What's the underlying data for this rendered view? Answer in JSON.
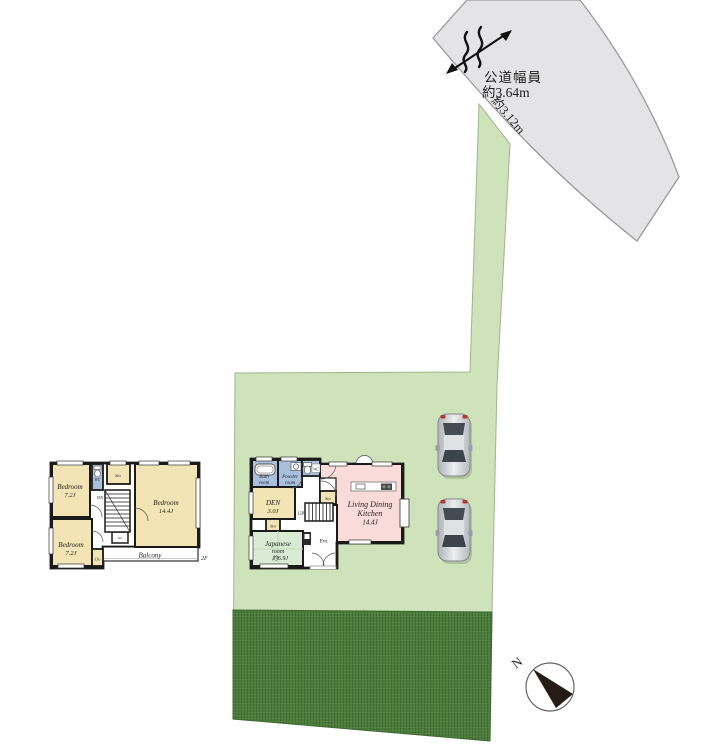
{
  "road": {
    "width_label_line1": "公道幅員",
    "width_label_line2": "約3.64m",
    "approach_width_label": "約3.12m"
  },
  "compass": {
    "north": "N"
  },
  "floor1": {
    "bath": {
      "l1": "Bath",
      "l2": "room"
    },
    "powder": {
      "l1": "Powder",
      "l2": "room"
    },
    "wc": "WC",
    "den": {
      "l1": "DEN",
      "l2": "3.0J"
    },
    "sto_hall": "Sto",
    "sto_den": "Sto",
    "up": "UP",
    "ent": "Ent.",
    "japanese": {
      "l1": "Japanese",
      "l2": "room",
      "l3": "約6.9J"
    },
    "ldk": {
      "l1": "Living Dining",
      "l2": "Kitchen",
      "l3": "14.4J"
    }
  },
  "floor2": {
    "bedroom_nw": {
      "l1": "Bedroom",
      "l2": "7.2J"
    },
    "bedroom_e": {
      "l1": "Bedroom",
      "l2": "14.4J"
    },
    "bedroom_sw": {
      "l1": "Bedroom",
      "l2": "7.2J"
    },
    "wc": "WC",
    "sto_top": "Sto",
    "sto_mid": "Sto",
    "clo": "Clo",
    "dn": "DN",
    "balcony": "Balcony",
    "floor_label": "2F"
  },
  "colors": {
    "lot_green": "#cfe3ba",
    "garden_green": "#4c7b3c",
    "road_gray": "#e4e4e6",
    "room_cream": "#f2e4b4",
    "room_blue": "#a9c0dc",
    "room_pink": "#f9dcd9",
    "room_tatami_green": "#d9ebd4",
    "wall_black": "#1a1a1a"
  }
}
